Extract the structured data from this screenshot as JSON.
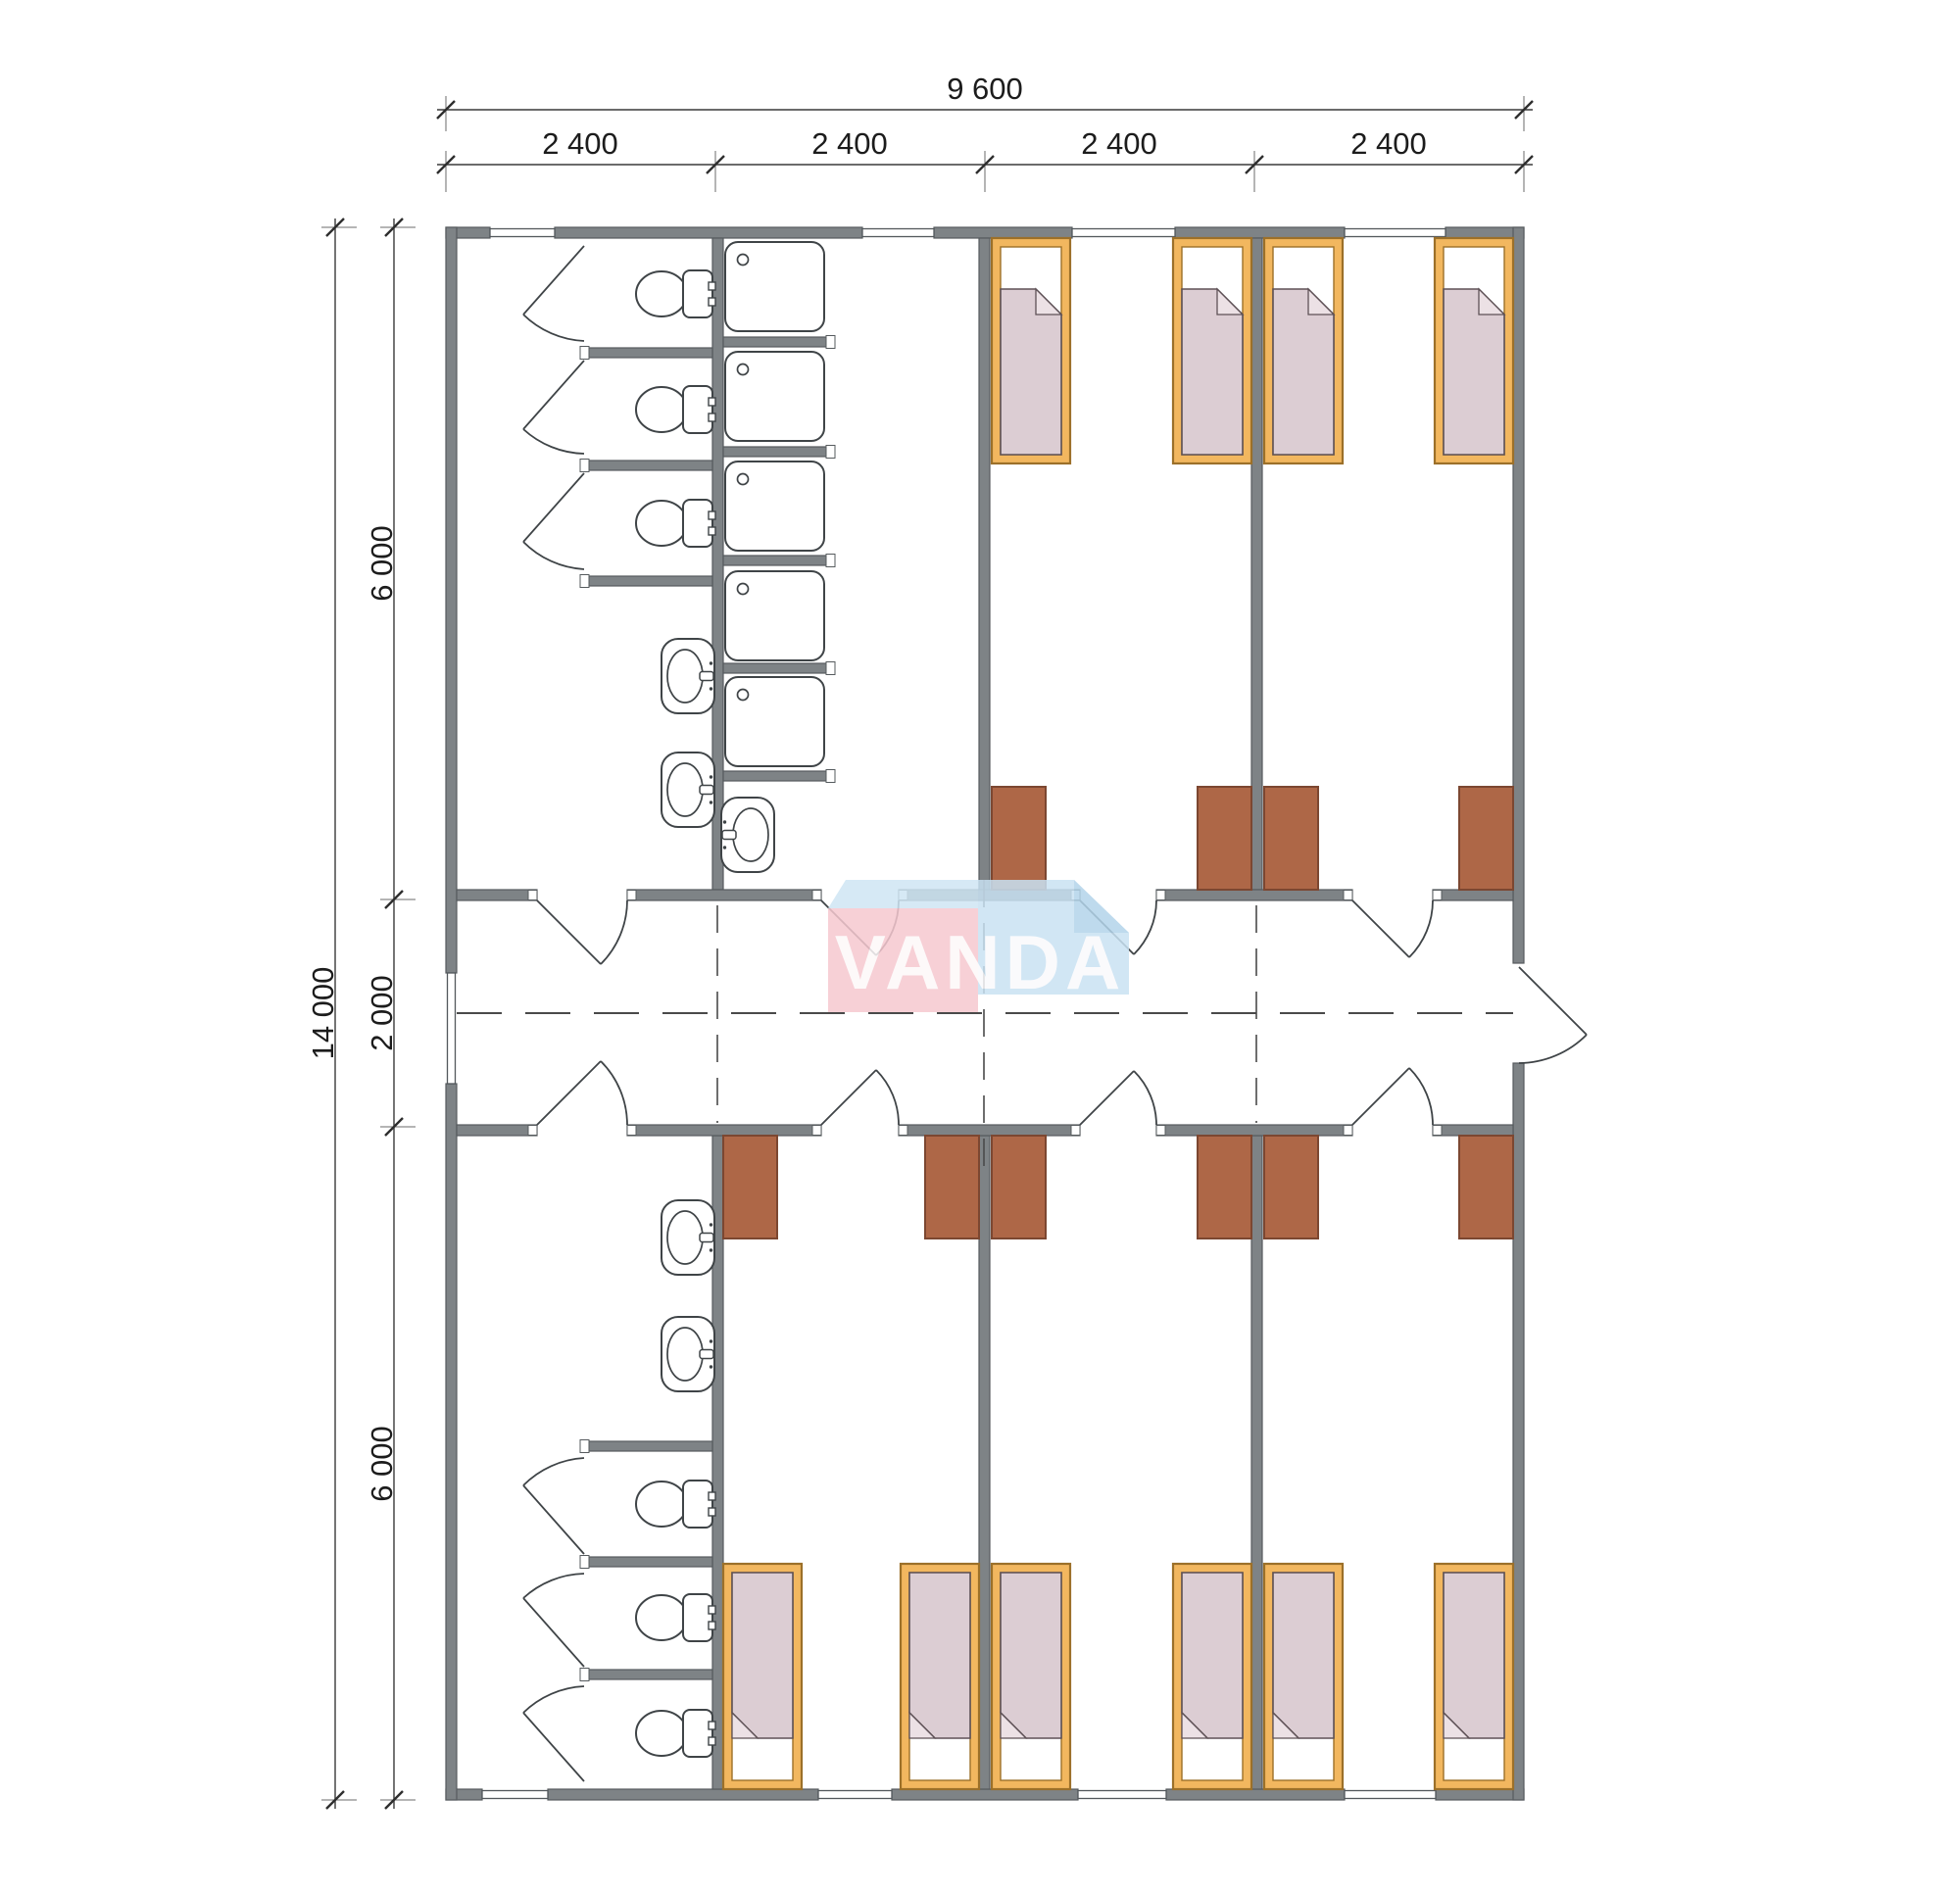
{
  "drawing": {
    "type": "modular dormitory floor plan",
    "watermark": {
      "text": "VANDA",
      "pink": "#f6c8d0",
      "blue": "#c9e2f3"
    },
    "dimensions": {
      "top": {
        "total": "9 600",
        "segments": [
          "2 400",
          "2 400",
          "2 400",
          "2 400"
        ]
      },
      "left": {
        "total": "14 000",
        "segments": [
          "6 000",
          "2 000",
          "6 000"
        ]
      }
    },
    "colors": {
      "wall": "#7e8386",
      "bed_frame": "#f2b75f",
      "mattress": "#dccdd3",
      "desk": "#ae6747",
      "fixture_line": "#3f4447"
    },
    "fixtures": {
      "toilets": 6,
      "shower_trays": 5,
      "wash_basins": 5,
      "beds": 10,
      "desks": 10,
      "room_doors": 8,
      "stall_doors": 6,
      "exterior_doors": 1,
      "windows": 9
    }
  }
}
